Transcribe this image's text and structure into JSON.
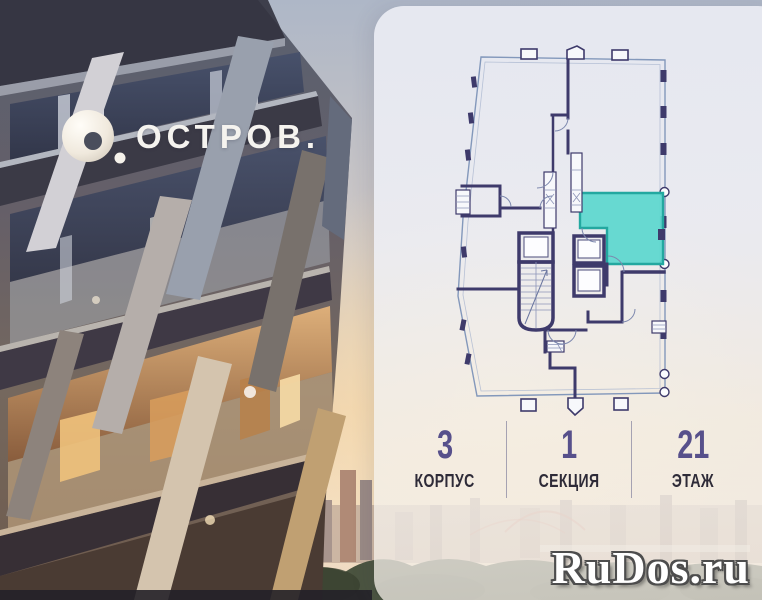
{
  "logo": {
    "text": "ОСТРОВ."
  },
  "stats": [
    {
      "value": "3",
      "label": "КОРПУС"
    },
    {
      "value": "1",
      "label": "СЕКЦИЯ"
    },
    {
      "value": "21",
      "label": "ЭТАЖ"
    }
  ],
  "watermark": {
    "text": "RuDos.ru"
  },
  "colors": {
    "accent_teal": "#5bd7ce",
    "teal_border": "#23a8a0",
    "wall_navy": "#3e3a6b",
    "plan_line": "#8398bb",
    "stat_number": "#57508b",
    "stat_label": "#2e2b38",
    "divider": "#a5a2b2"
  }
}
